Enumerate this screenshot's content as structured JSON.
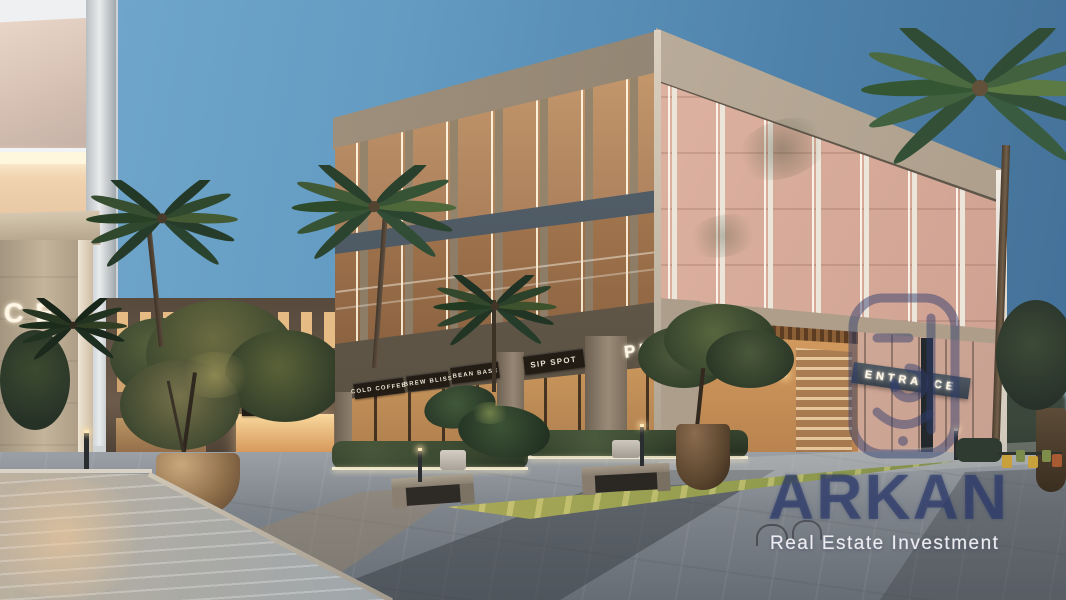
{
  "signs": {
    "pylon_letters": "CE",
    "background_entrance": "ENTRANCE",
    "cafe": "ZEP TH CAFE",
    "storefronts": [
      "COLD COFFEE",
      "BREW BLISS",
      "BEAN BASE",
      "SIP SPOT"
    ],
    "corner_shop": "PREK",
    "main_entrance": "ENTRANCE"
  },
  "watermark": {
    "brand": "ARKAN",
    "tagline": "Real Estate Investment",
    "logo_icon": "arkan-arabic-monogram-icon",
    "color": "#2a3869"
  },
  "palette": {
    "sky_light": "#74a9cd",
    "sky_deep": "#436f96",
    "sunset_glow": "#f0d6c6",
    "stone": "#b9a795",
    "warm_interior": "#f2c488",
    "slab_band": "#45505a",
    "plaza_grey": "#777d84",
    "water": "#96a3ae",
    "foliage_dark": "#2f4a33",
    "grass": "#8f9a4e",
    "watermark_navy": "#2a3869"
  }
}
